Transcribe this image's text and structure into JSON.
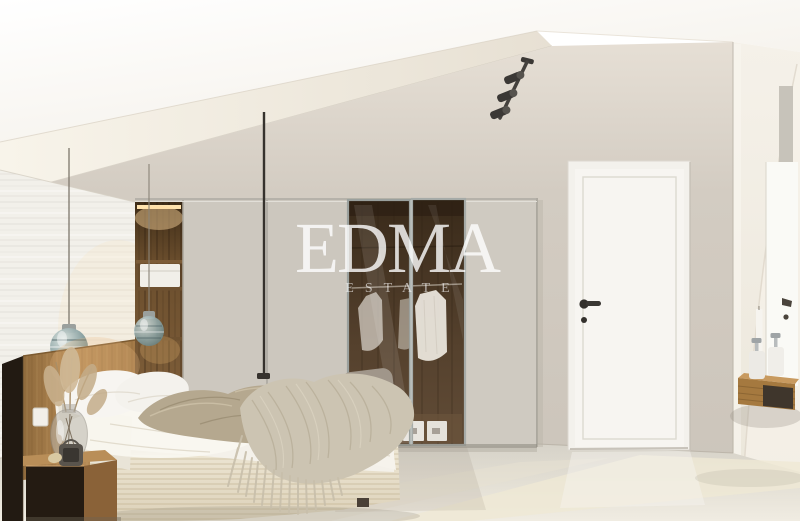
{
  "scene": {
    "type": "3d-interior-render",
    "subject": "attic bedroom with built-in wardrobe, bed, white door and vanity shelf",
    "watermark": {
      "title": "EDMA",
      "subtitle": "ESTATE"
    },
    "palette": {
      "ceiling_white": "#fbfaf6",
      "soffit_cream": "#efe9df",
      "wall_greige": "#d3cdc3",
      "left_wall_white": "#f2f0ea",
      "wardrobe_panel": "#cdc8bf",
      "niche_wood": "#6f5130",
      "glass_interior": "#4a3826",
      "frame_metal": "#9ba09d",
      "door_white": "#f7f5f1",
      "door_wall": "#cbc4ba",
      "pillar_cream": "#f0ece3",
      "floor_cream": "#e5e1d7",
      "headboard_oak": "#a87e4e",
      "nightstand_dark": "#241b12",
      "bedding_white": "#f4f1ea",
      "textile_taupe": "#b5a88f",
      "knit_throw": "#ccc4b2",
      "pendant_glass": "#6d878a",
      "track_light_black": "#3b3835",
      "handle_black": "#33302c",
      "shelf_oak": "#a5793f",
      "watermark_white": "#ffffff"
    },
    "objects": [
      "sloped ceiling",
      "track spotlights",
      "textured accent wall",
      "built-in wardrobe",
      "open shelving niche",
      "glass wardrobe doors",
      "hanging clothes",
      "white interior door",
      "bed with knit throw",
      "wood headboard",
      "nightstand",
      "glass pendant lights",
      "dried pampas decor",
      "floating vanity shelf",
      "soap dispensers",
      "mirror"
    ]
  }
}
